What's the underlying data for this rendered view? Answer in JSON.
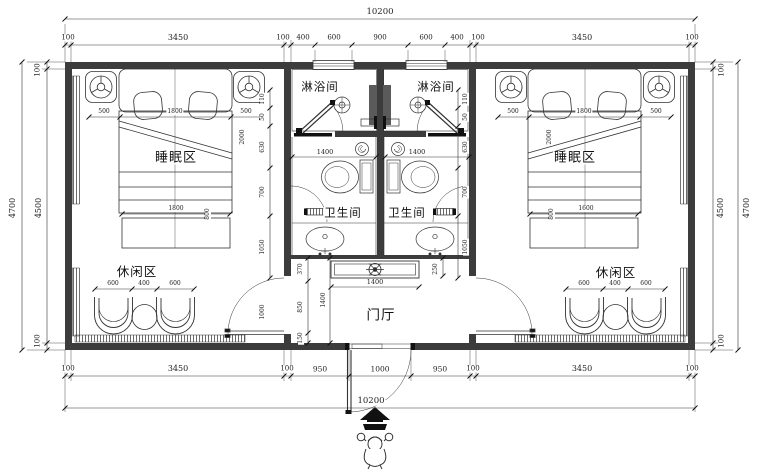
{
  "plan": {
    "rooms": {
      "shower_left": "淋浴间",
      "shower_right": "淋浴间",
      "toilet_left": "卫生间",
      "toilet_right": "卫生间",
      "sleep_left": "睡眠区",
      "sleep_right": "睡眠区",
      "leisure_left": "休闲区",
      "leisure_right": "休闲区",
      "foyer": "门厅"
    },
    "dims": {
      "top_total": "10200",
      "top_row": [
        "100",
        "3450",
        "100",
        "400",
        "600",
        "900",
        "600",
        "400",
        "100",
        "3450",
        "100"
      ],
      "bottom_row": [
        "100",
        "3450",
        "100",
        "950",
        "1000",
        "950",
        "100",
        "3450",
        "100"
      ],
      "bottom_total": "10200",
      "left_outer": "4700",
      "left_inner": "4500",
      "left_top": "100",
      "left_bottom": "100",
      "right_outer": "4700",
      "right_inner": "4500",
      "right_top": "100",
      "right_bottom": "100",
      "bed_left": [
        "500",
        "1800",
        "500"
      ],
      "bed_right": [
        "500",
        "1800",
        "500"
      ],
      "bed_left_diag": "2000",
      "bed_right_diag": "2000",
      "bench_left": [
        "1800",
        "800"
      ],
      "bench_right": [
        "1600",
        "800"
      ],
      "chairs_left": [
        "600",
        "400",
        "600"
      ],
      "chairs_right": [
        "600",
        "400",
        "600"
      ],
      "shower_left_width": "1400",
      "shower_right_width": "1400",
      "side_chain": [
        "110",
        "50",
        "630",
        "700",
        "1050"
      ],
      "foyer_chain": [
        "370",
        "850",
        "150"
      ],
      "foyer_depth": "1400",
      "cabinet_width": "1400",
      "cabinet_depth": "250",
      "door_width": "1000"
    }
  }
}
